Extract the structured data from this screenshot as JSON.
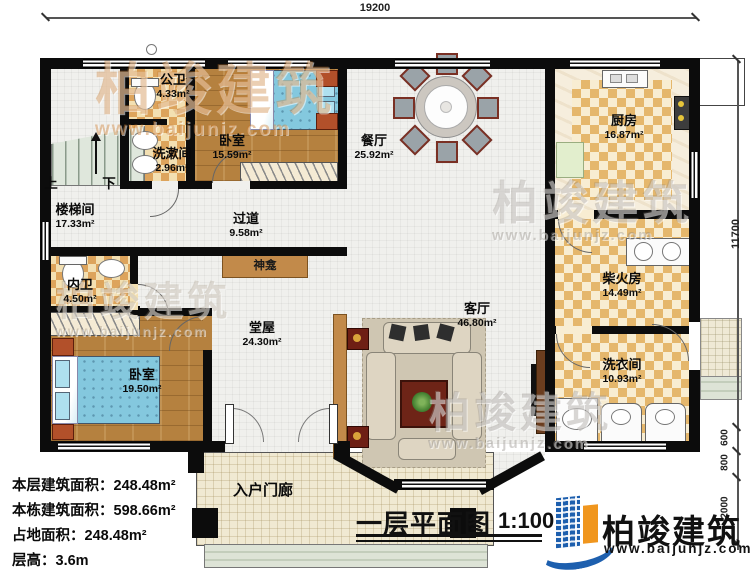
{
  "title": {
    "text": "一层平面图",
    "scale": "1:100"
  },
  "brand": {
    "name": "柏竣建筑",
    "site": "www.baijunjz.com"
  },
  "watermark": {
    "text": "柏竣建筑",
    "site": "www.baijunjz.com"
  },
  "dimensions": {
    "top": "19200",
    "right": "11700",
    "right_lower": [
      "600",
      "800",
      "2000"
    ]
  },
  "stats": [
    {
      "label": "本层建筑面积：",
      "value": "248.48m²"
    },
    {
      "label": "本栋建筑面积：",
      "value": "598.66m²"
    },
    {
      "label": "占地面积：",
      "value": "248.48m²"
    },
    {
      "label": "层高：",
      "value": "3.6m"
    }
  ],
  "rooms": [
    {
      "id": "stairwell",
      "name": "楼梯间",
      "area": "17.33m²"
    },
    {
      "id": "public-bathroom",
      "name": "公卫",
      "area": "4.33m²"
    },
    {
      "id": "washroom",
      "name": "洗漱间",
      "area": "2.96m²"
    },
    {
      "id": "bedroom-1",
      "name": "卧室",
      "area": "15.59m²"
    },
    {
      "id": "dining-room",
      "name": "餐厅",
      "area": "25.92m²"
    },
    {
      "id": "kitchen",
      "name": "厨房",
      "area": "16.87m²"
    },
    {
      "id": "hallway",
      "name": "过道",
      "area": "9.58m²"
    },
    {
      "id": "firewood-room",
      "name": "柴火房",
      "area": "14.49m²"
    },
    {
      "id": "inner-bathroom",
      "name": "内卫",
      "area": "4.50m²"
    },
    {
      "id": "main-hall",
      "name": "堂屋",
      "area": "24.30m²"
    },
    {
      "id": "bedroom-2",
      "name": "卧室",
      "area": "19.50m²"
    },
    {
      "id": "living-room",
      "name": "客厅",
      "area": "46.80m²"
    },
    {
      "id": "laundry-room",
      "name": "洗衣间",
      "area": "10.93m²"
    },
    {
      "id": "entry-porch",
      "name": "入户门廊",
      "area": ""
    }
  ],
  "annotations": {
    "up": "上",
    "down": "下",
    "shrine": "神龛"
  },
  "colors": {
    "wall": "#0c0c0c",
    "wood_floor": "#b5813f",
    "checker_tile": "#dda45c",
    "bed": "#84c8de",
    "logo_blue": "#1d5fae",
    "logo_orange": "#f0961e"
  }
}
